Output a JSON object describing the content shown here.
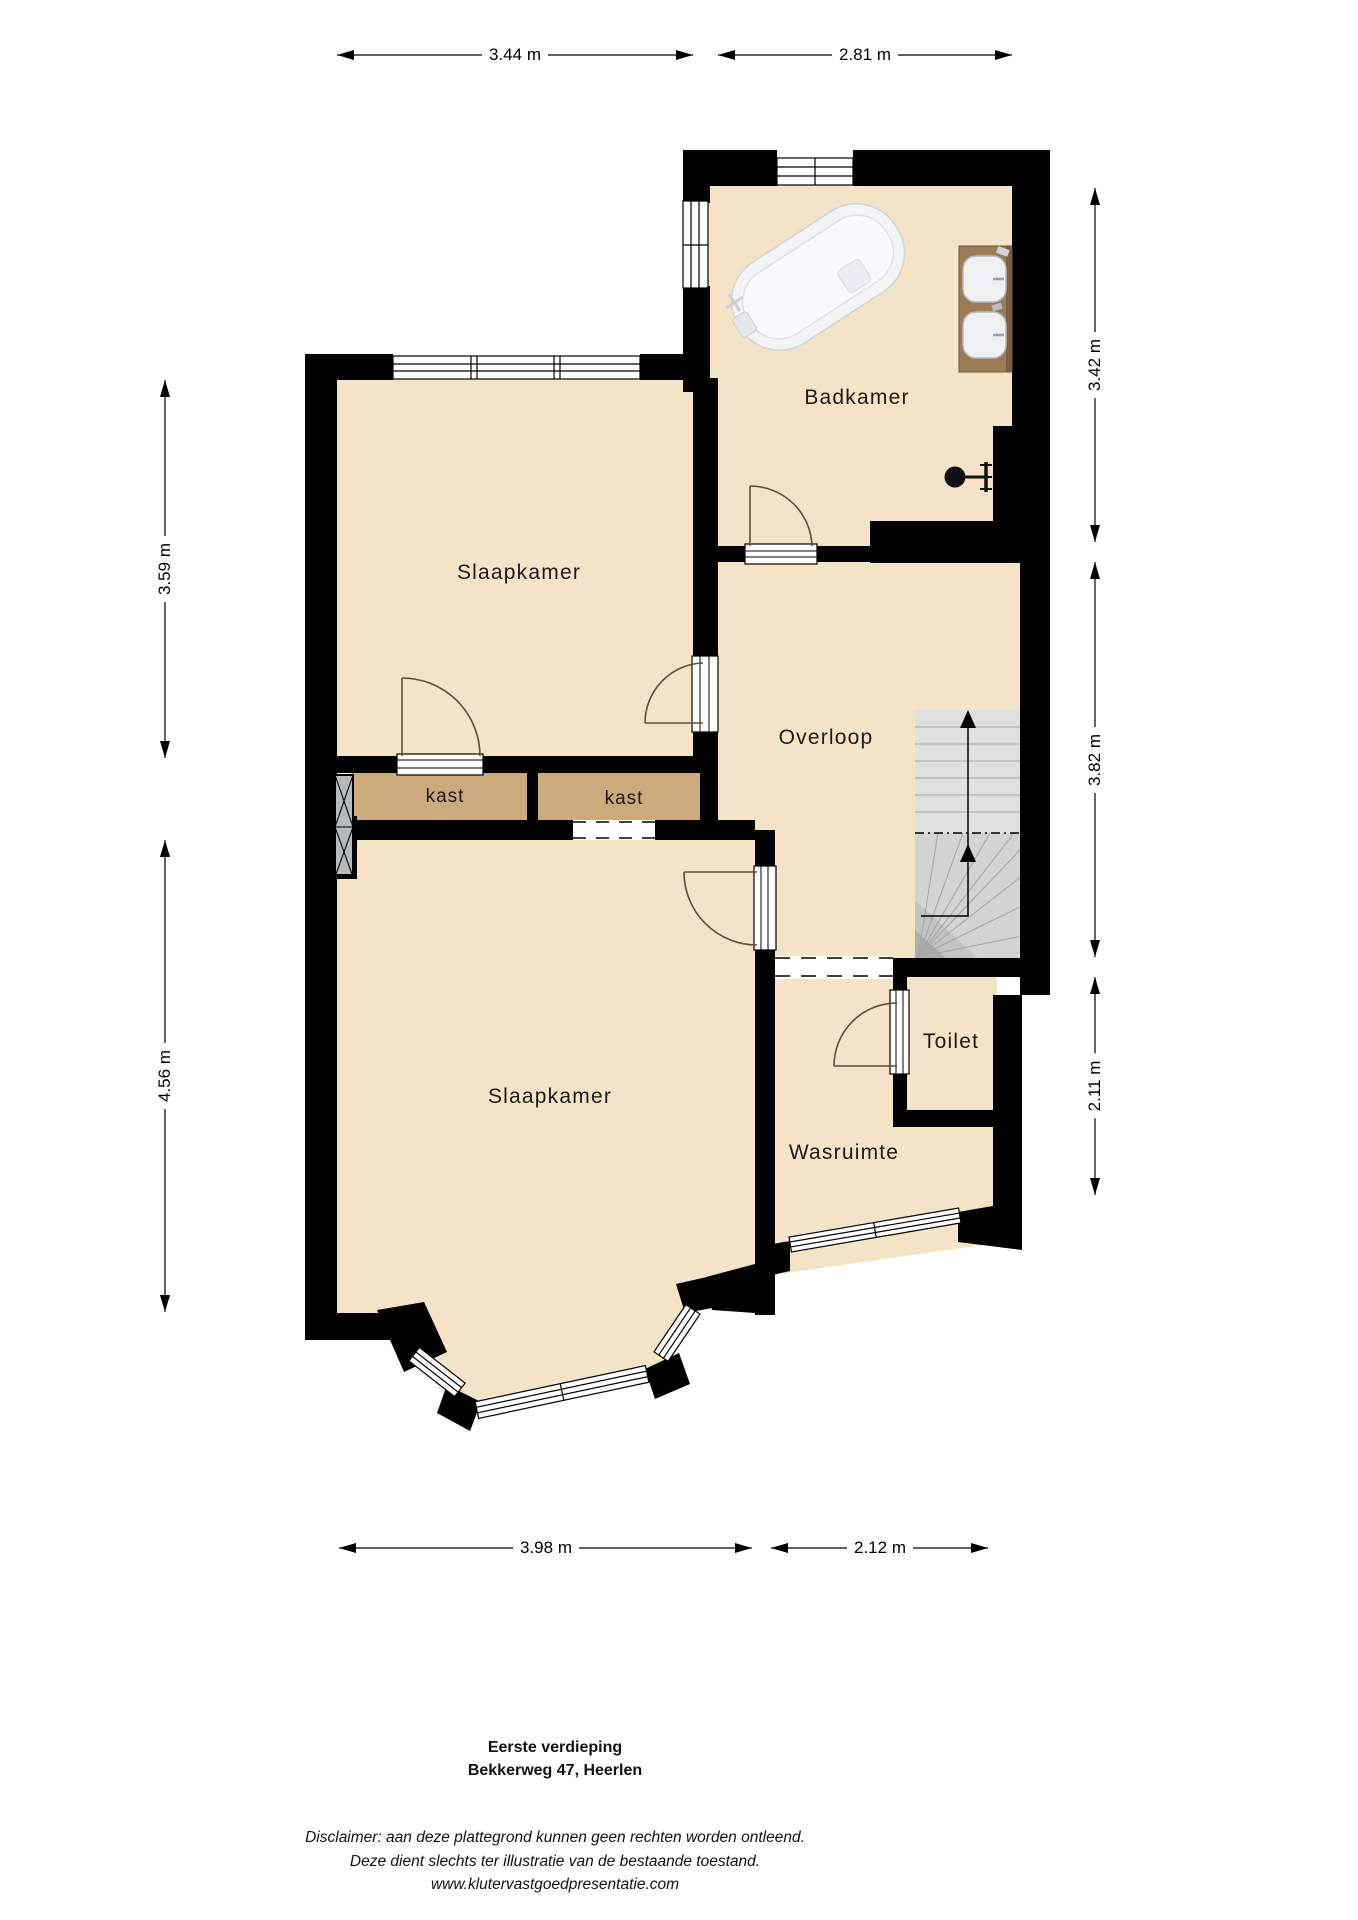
{
  "rooms": {
    "badkamer": {
      "label": "Badkamer"
    },
    "slaapkamer_boven": {
      "label": "Slaapkamer"
    },
    "overloop": {
      "label": "Overloop"
    },
    "kast_links": {
      "label": "kast"
    },
    "kast_rechts": {
      "label": "kast"
    },
    "slaapkamer_beneden": {
      "label": "Slaapkamer"
    },
    "toilet": {
      "label": "Toilet"
    },
    "wasruimte": {
      "label": "Wasruimte"
    }
  },
  "dimensions": {
    "top": [
      {
        "label": "3.44 m"
      },
      {
        "label": "2.81 m"
      }
    ],
    "left": [
      {
        "label": "3.59 m"
      },
      {
        "label": "4.56 m"
      }
    ],
    "right": [
      {
        "label": "3.42 m"
      },
      {
        "label": "3.82 m"
      },
      {
        "label": "2.11 m"
      }
    ],
    "bottom": [
      {
        "label": "3.98 m"
      },
      {
        "label": "2.12 m"
      }
    ]
  },
  "footer": {
    "floor_title": "Eerste verdieping",
    "address": "Bekkerweg 47, Heerlen",
    "disclaimer_line1": "Disclaimer: aan deze plattegrond kunnen geen rechten worden ontleend.",
    "disclaimer_line2": "Deze dient slechts ter illustratie van de bestaande toestand.",
    "disclaimer_line3": "www.klutervastgoedpresentatie.com"
  },
  "colors": {
    "floor": "#f5e3c7",
    "closet": "#cdaa7c",
    "wall": "#000000",
    "stairs": "#e0e0e0",
    "stairs_winder": "#d3d3d3",
    "counter": "#9c7c55",
    "label": "#1b1b1b"
  }
}
